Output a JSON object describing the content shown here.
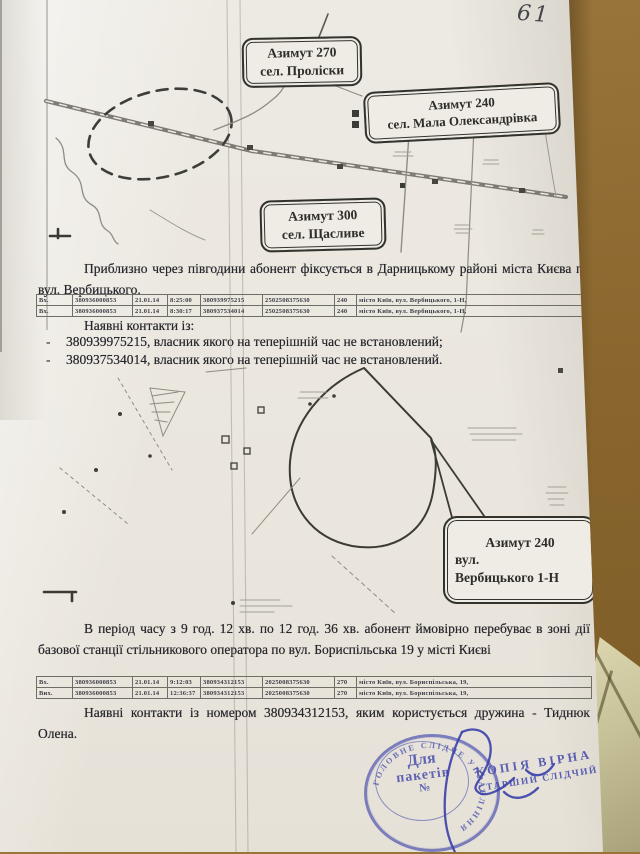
{
  "photo": {
    "page_number": "61"
  },
  "maps": {
    "map1_callouts": [
      {
        "l1": "Азимут 270",
        "l2": "сел. Проліски"
      },
      {
        "l1": "Азимут 240",
        "l2": "сел. Мала Олександрівка"
      },
      {
        "l1": "Азимут 300",
        "l2": "сел. Щасливе"
      }
    ],
    "map2_callout": {
      "l1": "Азимут 240",
      "l2": "вул.",
      "l3": "Вербицького 1-Н"
    }
  },
  "body_text": {
    "paragraph1": "Приблизно через півгодини абонент фіксується в Дарницькому районі міста Києва по вул. Вербицького.",
    "contacts_intro": "Наявні контакти із:",
    "dash": "-",
    "contact_items": [
      "380939975215, власник якого на теперішній час не встановлений;",
      "380937534014, власник якого на теперішній час не встановлений."
    ],
    "paragraph2": "В період часу з 9 год. 12 хв. по 12 год. 36 хв. абонент ймовірно перебуває в зоні дії базової станції стільникового оператора по вул. Бориспільська 19 у місті Києві",
    "paragraph3": "Наявні контакти із номером 380934312153, яким користується дружина - Тиднюк Олена."
  },
  "tables": [
    {
      "rows": [
        [
          "Вх.",
          "380936000853",
          "21.01.14",
          "8:25:00",
          "380939975215",
          "2502508375630",
          "240",
          "місто Київ, вул. Вербицького, 1-Н,"
        ],
        [
          "Вх.",
          "380936000853",
          "21.01.14",
          "8:30:17",
          "380937534014",
          "2502508375630",
          "240",
          "місто Київ, вул. Вербицького, 1-Н,"
        ]
      ]
    },
    {
      "rows": [
        [
          "Вх.",
          "380936000853",
          "21.01.14",
          "9:12:03",
          "380934312153",
          "2025008375630",
          "270",
          "місто Київ, вул. Бориспільська, 19,"
        ],
        [
          "Вих.",
          "380936000853",
          "21.01.14",
          "12:36:37",
          "380934312153",
          "2025008375630",
          "270",
          "місто Київ, вул. Бориспільська, 19,"
        ]
      ]
    }
  ],
  "stamp": {
    "arc_text": "ГОЛОВНЕ СЛІДЧЕ УПРАВЛІННЯ",
    "center_line1": "Для",
    "center_line2": "пакетів",
    "center_line3": "№",
    "copy_line1": "КОПІЯ ВІРНА",
    "copy_line2": "СТАРШИЙ СЛІДЧИЙ"
  },
  "colors": {
    "stamp_ink": "#4d53af",
    "text_ink": "#26262c",
    "wood": "#8a672e",
    "paper": "#eae6de"
  }
}
